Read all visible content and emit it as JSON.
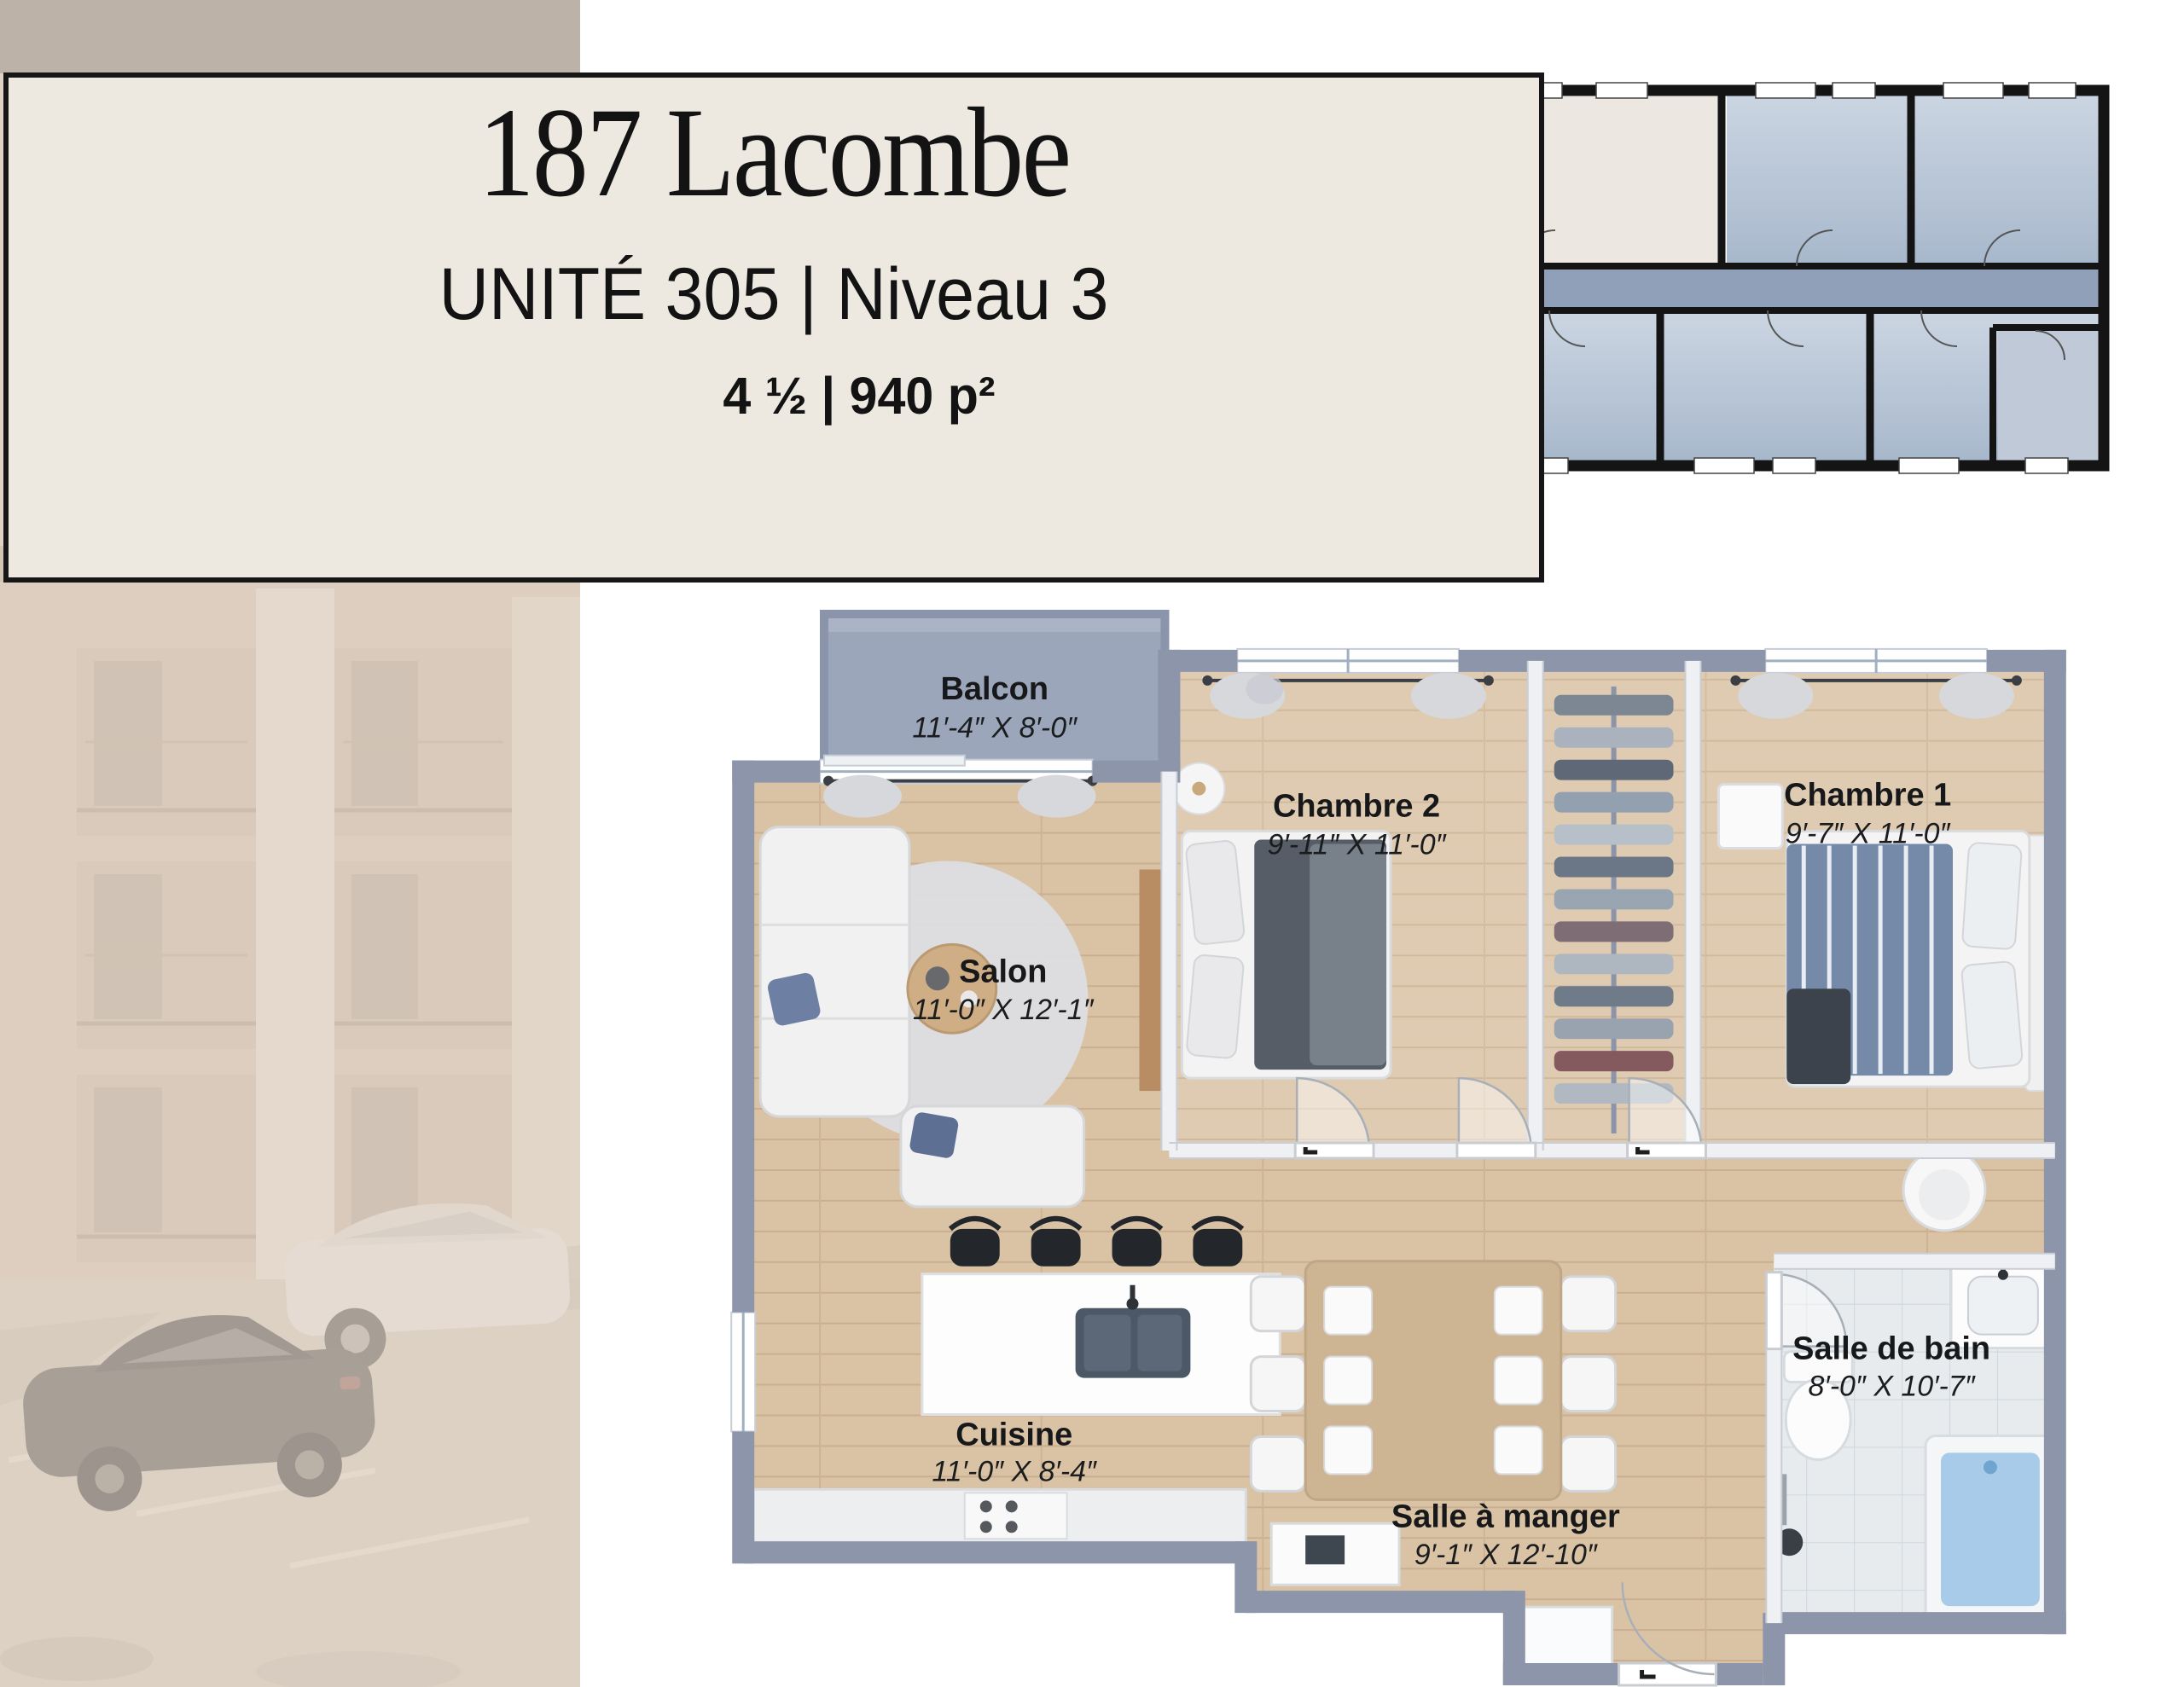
{
  "header": {
    "title": "187 Lacombe",
    "unit_line": "UNITÉ 305 | Niveau 3",
    "size_line": "4 ½ | 940 p²"
  },
  "rooms": {
    "balcon": {
      "name": "Balcon",
      "dims": "11′-4″ X 8′-0″"
    },
    "chambre2": {
      "name": "Chambre 2",
      "dims": "9′-11″ X 11′-0″"
    },
    "chambre1": {
      "name": "Chambre 1",
      "dims": "9′-7″ X 11′-0″"
    },
    "salon": {
      "name": "Salon",
      "dims": "11′-0″ X 12′-1″"
    },
    "cuisine": {
      "name": "Cuisine",
      "dims": "11′-0″ X 8′-4″"
    },
    "salle_a_manger": {
      "name": "Salle à manger",
      "dims": "9′-1″ X 12′-10″"
    },
    "salle_de_bain": {
      "name": "Salle de bain",
      "dims": "8′-0″ X 10′-7″"
    }
  },
  "colors": {
    "card_cream": "#EDE9E1",
    "border_black": "#161616",
    "wall_gray": "#8C95A9",
    "wood_floor": "#DAC3A5",
    "tile_floor": "#E7EBEE",
    "keyplan_room_blue": "#C2CEDC",
    "keyplan_corridor": "#8FA0B8",
    "keyplan_highlight": "#ECE8E1",
    "bath_water_blue": "#A7CBE8",
    "photo_beige": "#CDBCAD"
  }
}
